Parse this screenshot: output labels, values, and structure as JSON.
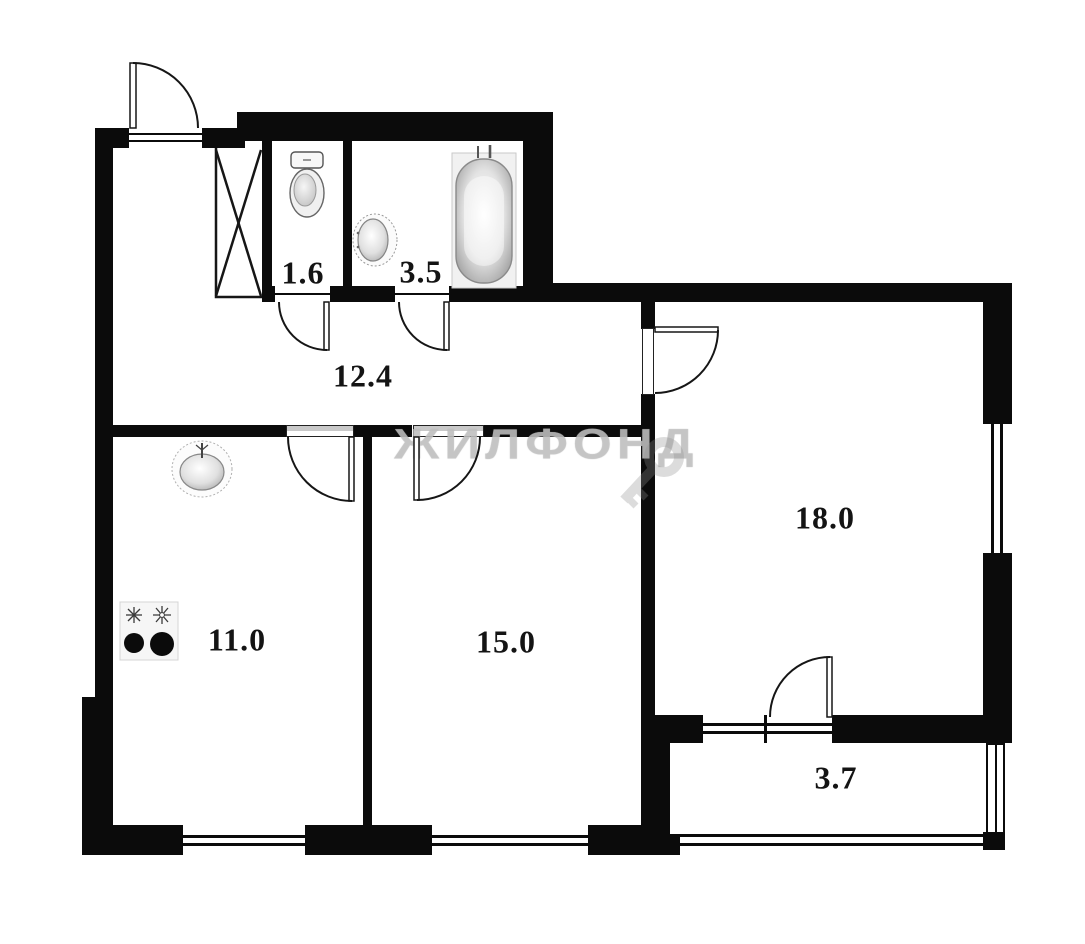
{
  "watermark": {
    "brand": "ЖИЛФОНД",
    "key_icon": "key-icon"
  },
  "rooms": {
    "wc": {
      "name": "wc",
      "area": "1.6"
    },
    "bathroom": {
      "name": "bathroom",
      "area": "3.5"
    },
    "hallway": {
      "name": "hallway",
      "area": "12.4"
    },
    "kitchen": {
      "name": "kitchen",
      "area": "11.0"
    },
    "bedroom": {
      "name": "room-15",
      "area": "15.0"
    },
    "living": {
      "name": "room-18",
      "area": "18.0"
    },
    "balcony": {
      "name": "balcony",
      "area": "3.7"
    }
  },
  "fixtures": {
    "toilet": "toilet-icon",
    "bath_sink": "washbasin-icon",
    "bathtub": "bathtub-icon",
    "kitchen_sink": "kitchen-sink-icon",
    "stove": "stove-icon",
    "wardrobe": "wardrobe-cross-icon"
  },
  "colors": {
    "walls": "#0b0b0b",
    "background": "#ffffff",
    "watermark": "#c6c6c6"
  }
}
